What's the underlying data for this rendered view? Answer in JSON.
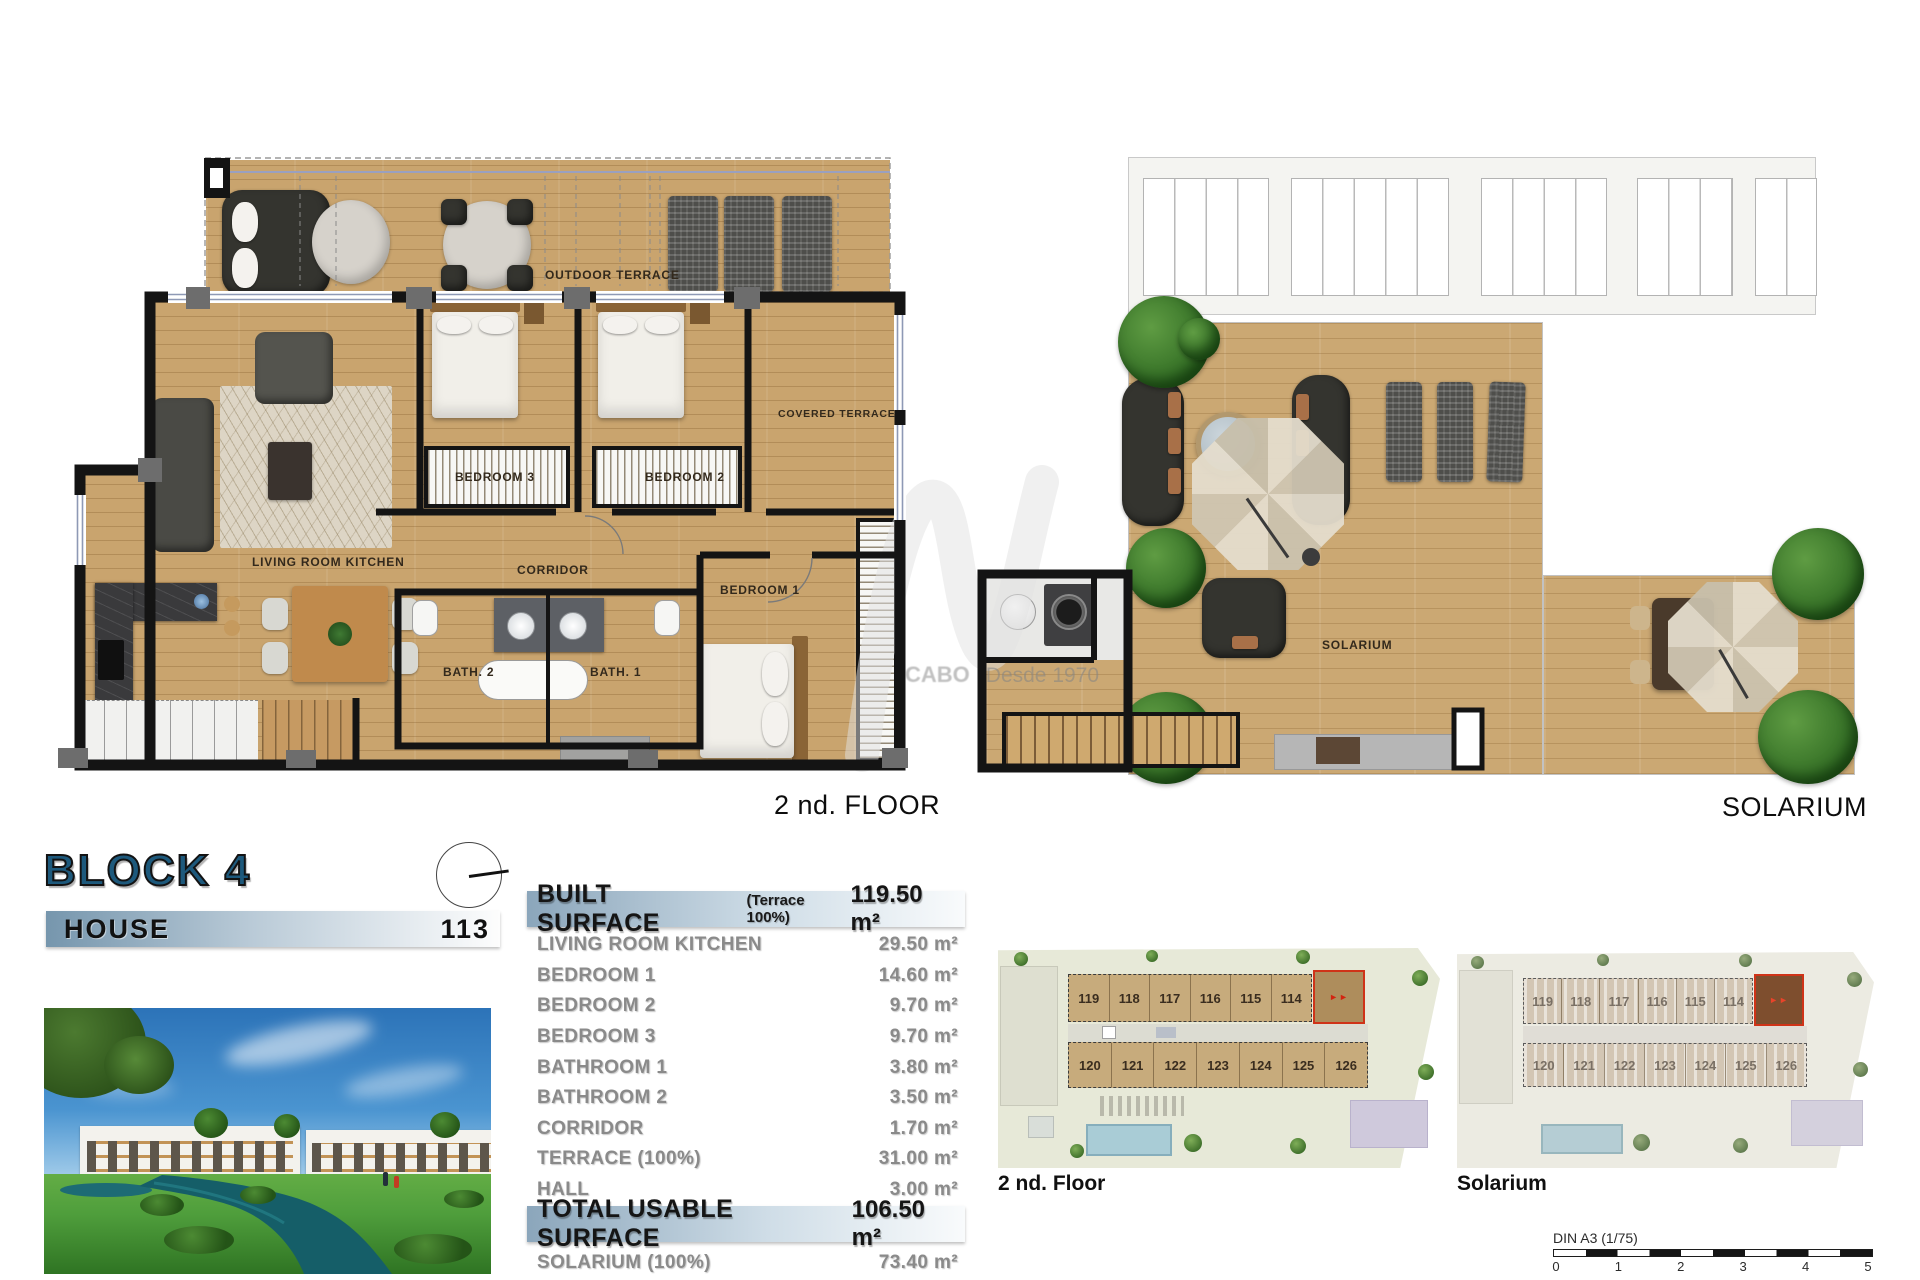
{
  "header": {
    "block_title": "BLOCK 4",
    "house_label": "HOUSE",
    "house_number": "113"
  },
  "plans": {
    "second_floor": {
      "caption": "2 nd. FLOOR",
      "rooms": {
        "outdoor_terrace": "OUTDOOR TERRACE",
        "covered_terrace": "COVERED TERRACE",
        "bedroom3": "BEDROOM 3",
        "bedroom2": "BEDROOM 2",
        "bedroom1": "BEDROOM 1",
        "living": "LIVING ROOM KITCHEN",
        "corridor": "CORRIDOR",
        "bath2": "BATH. 2",
        "bath1": "BATH. 1"
      }
    },
    "solarium": {
      "caption": "SOLARIUM",
      "room_label": "SOLARIUM"
    }
  },
  "surface_table": {
    "header": {
      "label": "BUILT SURFACE",
      "note": "(Terrace 100%)",
      "value": "119.50 m²"
    },
    "rows": [
      {
        "label": "LIVING ROOM KITCHEN",
        "value": "29.50 m²"
      },
      {
        "label": "BEDROOM 1",
        "value": "14.60 m²"
      },
      {
        "label": "BEDROOM 2",
        "value": "9.70 m²"
      },
      {
        "label": "BEDROOM 3",
        "value": "9.70 m²"
      },
      {
        "label": "BATHROOM 1",
        "value": "3.80 m²"
      },
      {
        "label": "BATHROOM 2",
        "value": "3.50 m²"
      },
      {
        "label": "CORRIDOR",
        "value": "1.70 m²"
      },
      {
        "label": "TERRACE (100%)",
        "value": "31.00 m²"
      },
      {
        "label": "HALL",
        "value": "3.00 m²"
      }
    ],
    "total": {
      "label": "TOTAL USABLE SURFACE",
      "value": "106.50 m²"
    },
    "solarium_row": {
      "label": "SOLARIUM (100%)",
      "value": "73.40 m²"
    }
  },
  "site_plans": {
    "left": {
      "caption": "2 nd. Floor",
      "top_units": [
        "119",
        "118",
        "117",
        "116",
        "115",
        "114"
      ],
      "bottom_units": [
        "120",
        "121",
        "122",
        "123",
        "124",
        "125",
        "126"
      ],
      "highlight_marks": "►►"
    },
    "right": {
      "caption": "Solarium",
      "top_units": [
        "119",
        "118",
        "117",
        "116",
        "115",
        "114"
      ],
      "bottom_units": [
        "120",
        "121",
        "122",
        "123",
        "124",
        "125",
        "126"
      ],
      "highlight_marks": "►►"
    }
  },
  "scale_bar": {
    "label": "DIN A3 (1/75)",
    "ticks": [
      "0",
      "1",
      "2",
      "3",
      "4",
      "5"
    ]
  },
  "watermark": {
    "brand": "CABO",
    "tagline": "Desde 1970"
  },
  "colors": {
    "accent_blue": "#1d597c",
    "bar_gradient_start": "#8ba6bb",
    "highlight_red": "#cf3318",
    "wood": "#c9a46e"
  }
}
